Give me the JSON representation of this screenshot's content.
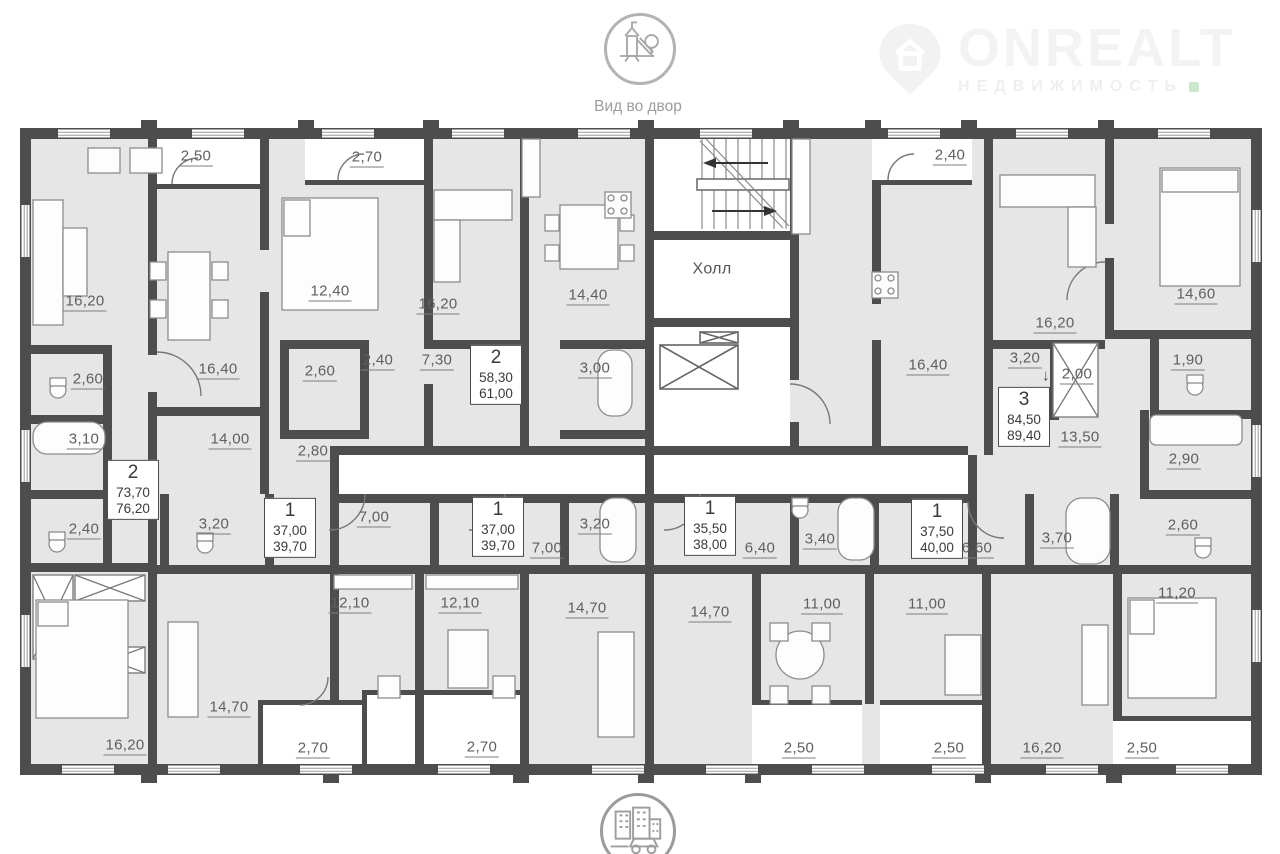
{
  "header": {
    "view_label": "Вид во двор"
  },
  "brand": {
    "name": "ONREALT",
    "tagline": "НЕДВИЖИМОСТЬ"
  },
  "colors": {
    "wall": "#4d4d4d",
    "room_fill": "#e6e6e6",
    "label_text": "#5f5f5f",
    "brand_text": "#f3f3f3",
    "accent_green": "#cde7cd"
  },
  "plan": {
    "hall_label": "Холл",
    "labels": [
      {
        "text": "2,50",
        "x": 196,
        "y": 157
      },
      {
        "text": "2,70",
        "x": 367,
        "y": 158
      },
      {
        "text": "2,40",
        "x": 950,
        "y": 156
      },
      {
        "text": "16,20",
        "x": 85,
        "y": 302
      },
      {
        "text": "12,40",
        "x": 330,
        "y": 292
      },
      {
        "text": "16,20",
        "x": 438,
        "y": 305
      },
      {
        "text": "14,40",
        "x": 588,
        "y": 296
      },
      {
        "text": "Холл",
        "x": 712,
        "y": 270,
        "plain": true
      },
      {
        "text": "16,40",
        "x": 928,
        "y": 366
      },
      {
        "text": "16,20",
        "x": 1055,
        "y": 324
      },
      {
        "text": "14,60",
        "x": 1196,
        "y": 295
      },
      {
        "text": "2,60",
        "x": 88,
        "y": 380
      },
      {
        "text": "16,40",
        "x": 218,
        "y": 370
      },
      {
        "text": "2,60",
        "x": 320,
        "y": 372
      },
      {
        "text": "2,40",
        "x": 378,
        "y": 361
      },
      {
        "text": "7,30",
        "x": 437,
        "y": 361
      },
      {
        "text": "3,00",
        "x": 595,
        "y": 369
      },
      {
        "text": "3,20",
        "x": 1025,
        "y": 359
      },
      {
        "text": "↓",
        "x": 1046,
        "y": 377,
        "plain": true
      },
      {
        "text": "2,00",
        "x": 1077,
        "y": 375
      },
      {
        "text": "1,90",
        "x": 1188,
        "y": 361
      },
      {
        "text": "3,10",
        "x": 84,
        "y": 440
      },
      {
        "text": "14,00",
        "x": 230,
        "y": 440
      },
      {
        "text": "2,80",
        "x": 313,
        "y": 452
      },
      {
        "text": "13,50",
        "x": 1080,
        "y": 438
      },
      {
        "text": "2,90",
        "x": 1184,
        "y": 460
      },
      {
        "text": "2,40",
        "x": 84,
        "y": 530
      },
      {
        "text": "3,20",
        "x": 214,
        "y": 525
      },
      {
        "text": "7,00",
        "x": 374,
        "y": 518
      },
      {
        "text": "3,20",
        "x": 595,
        "y": 525
      },
      {
        "text": "7,00",
        "x": 547,
        "y": 549
      },
      {
        "text": "6,40",
        "x": 760,
        "y": 549
      },
      {
        "text": "3,40",
        "x": 820,
        "y": 540
      },
      {
        "text": "6,60",
        "x": 977,
        "y": 549
      },
      {
        "text": "3,70",
        "x": 1057,
        "y": 539
      },
      {
        "text": "2,60",
        "x": 1183,
        "y": 526
      },
      {
        "text": "11,20",
        "x": 1177,
        "y": 594
      },
      {
        "text": "12,10",
        "x": 350,
        "y": 604
      },
      {
        "text": "12,10",
        "x": 460,
        "y": 604
      },
      {
        "text": "14,70",
        "x": 587,
        "y": 609
      },
      {
        "text": "14,70",
        "x": 710,
        "y": 613
      },
      {
        "text": "11,00",
        "x": 822,
        "y": 605
      },
      {
        "text": "11,00",
        "x": 927,
        "y": 605
      },
      {
        "text": "14,70",
        "x": 229,
        "y": 708
      },
      {
        "text": "16,20",
        "x": 125,
        "y": 746
      },
      {
        "text": "16,20",
        "x": 1042,
        "y": 749
      },
      {
        "text": "2,70",
        "x": 313,
        "y": 749
      },
      {
        "text": "2,70",
        "x": 482,
        "y": 748
      },
      {
        "text": "2,50",
        "x": 799,
        "y": 749
      },
      {
        "text": "2,50",
        "x": 949,
        "y": 749
      },
      {
        "text": "2,50",
        "x": 1142,
        "y": 749
      }
    ],
    "badges": [
      {
        "num": "2",
        "area1": "73,70",
        "area2": "76,20",
        "x": 133,
        "y": 490
      },
      {
        "num": "2",
        "area1": "58,30",
        "area2": "61,00",
        "x": 496,
        "y": 375
      },
      {
        "num": "3",
        "area1": "84,50",
        "area2": "89,40",
        "x": 1024,
        "y": 417
      },
      {
        "num": "1",
        "area1": "37,00",
        "area2": "39,70",
        "x": 290,
        "y": 528
      },
      {
        "num": "1",
        "area1": "37,00",
        "area2": "39,70",
        "x": 498,
        "y": 527
      },
      {
        "num": "1",
        "area1": "35,50",
        "area2": "38,00",
        "x": 710,
        "y": 526
      },
      {
        "num": "1",
        "area1": "37,50",
        "area2": "40,00",
        "x": 937,
        "y": 529
      }
    ]
  }
}
